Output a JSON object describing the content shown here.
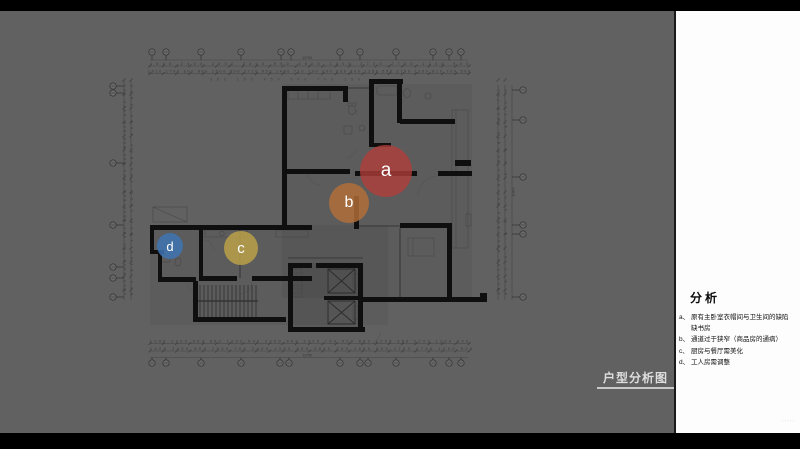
{
  "slide": {
    "background": "#000000",
    "canvas_gray": "#616161",
    "panel_white": "#fdfdfd"
  },
  "title_block": {
    "label": "户型分析图"
  },
  "analysis_panel": {
    "title": "分析",
    "items": [
      {
        "key": "a、",
        "text": "原有主卧室衣帽间与卫生间的缺陷\n缺书房"
      },
      {
        "key": "b、",
        "text": "通道过于狭窄（商品房的通病）"
      },
      {
        "key": "c、",
        "text": "厨房与餐厅需美化"
      },
      {
        "key": "d、",
        "text": "工人房需调整"
      }
    ],
    "watermark": "·····"
  },
  "markers": [
    {
      "label": "a",
      "x": 386,
      "y": 171,
      "r": 26,
      "color": "rgba(178,62,58,0.78)"
    },
    {
      "label": "b",
      "x": 349,
      "y": 203,
      "r": 20,
      "color": "rgba(181,112,56,0.82)"
    },
    {
      "label": "c",
      "x": 241,
      "y": 248,
      "r": 17,
      "color": "rgba(190,164,72,0.82)"
    },
    {
      "label": "d",
      "x": 170,
      "y": 246,
      "r": 13,
      "color": "rgba(62,116,178,0.85)"
    }
  ],
  "dimensions": {
    "top_total": "12750",
    "bottom_total": "12750",
    "right_total": "11400",
    "top_row1": "1000 2400 2900 2400 900 3800 1400 2700 2700 1200 900",
    "top_row2": "1010 1700 600 800 1000 900 2710 950 1480 710 700 200 950 800 1250 550 2700 1250 810 700 500",
    "top_row3": "380 150 450 500 700 150",
    "bottom_row1": "1000 1700 600 800 1200 900 2700 900 2400 700 900 800 1200 350 2700 1200 900",
    "bottom_row2": "1000 2400 500 2900 700 2400 1300 500 3800 200 1400 500 2700 2700 1200 900",
    "left_col1": "1500 2300 700 320 4300 800 2100 900 800 600 2900 700",
    "left_col2": "900 5100 1900 1100 700 600 1000 1500",
    "right_col1": "1500 700 2300 4300 800 2100 900 800 2900 700",
    "right_col2": "2300 4300 900 4700"
  }
}
